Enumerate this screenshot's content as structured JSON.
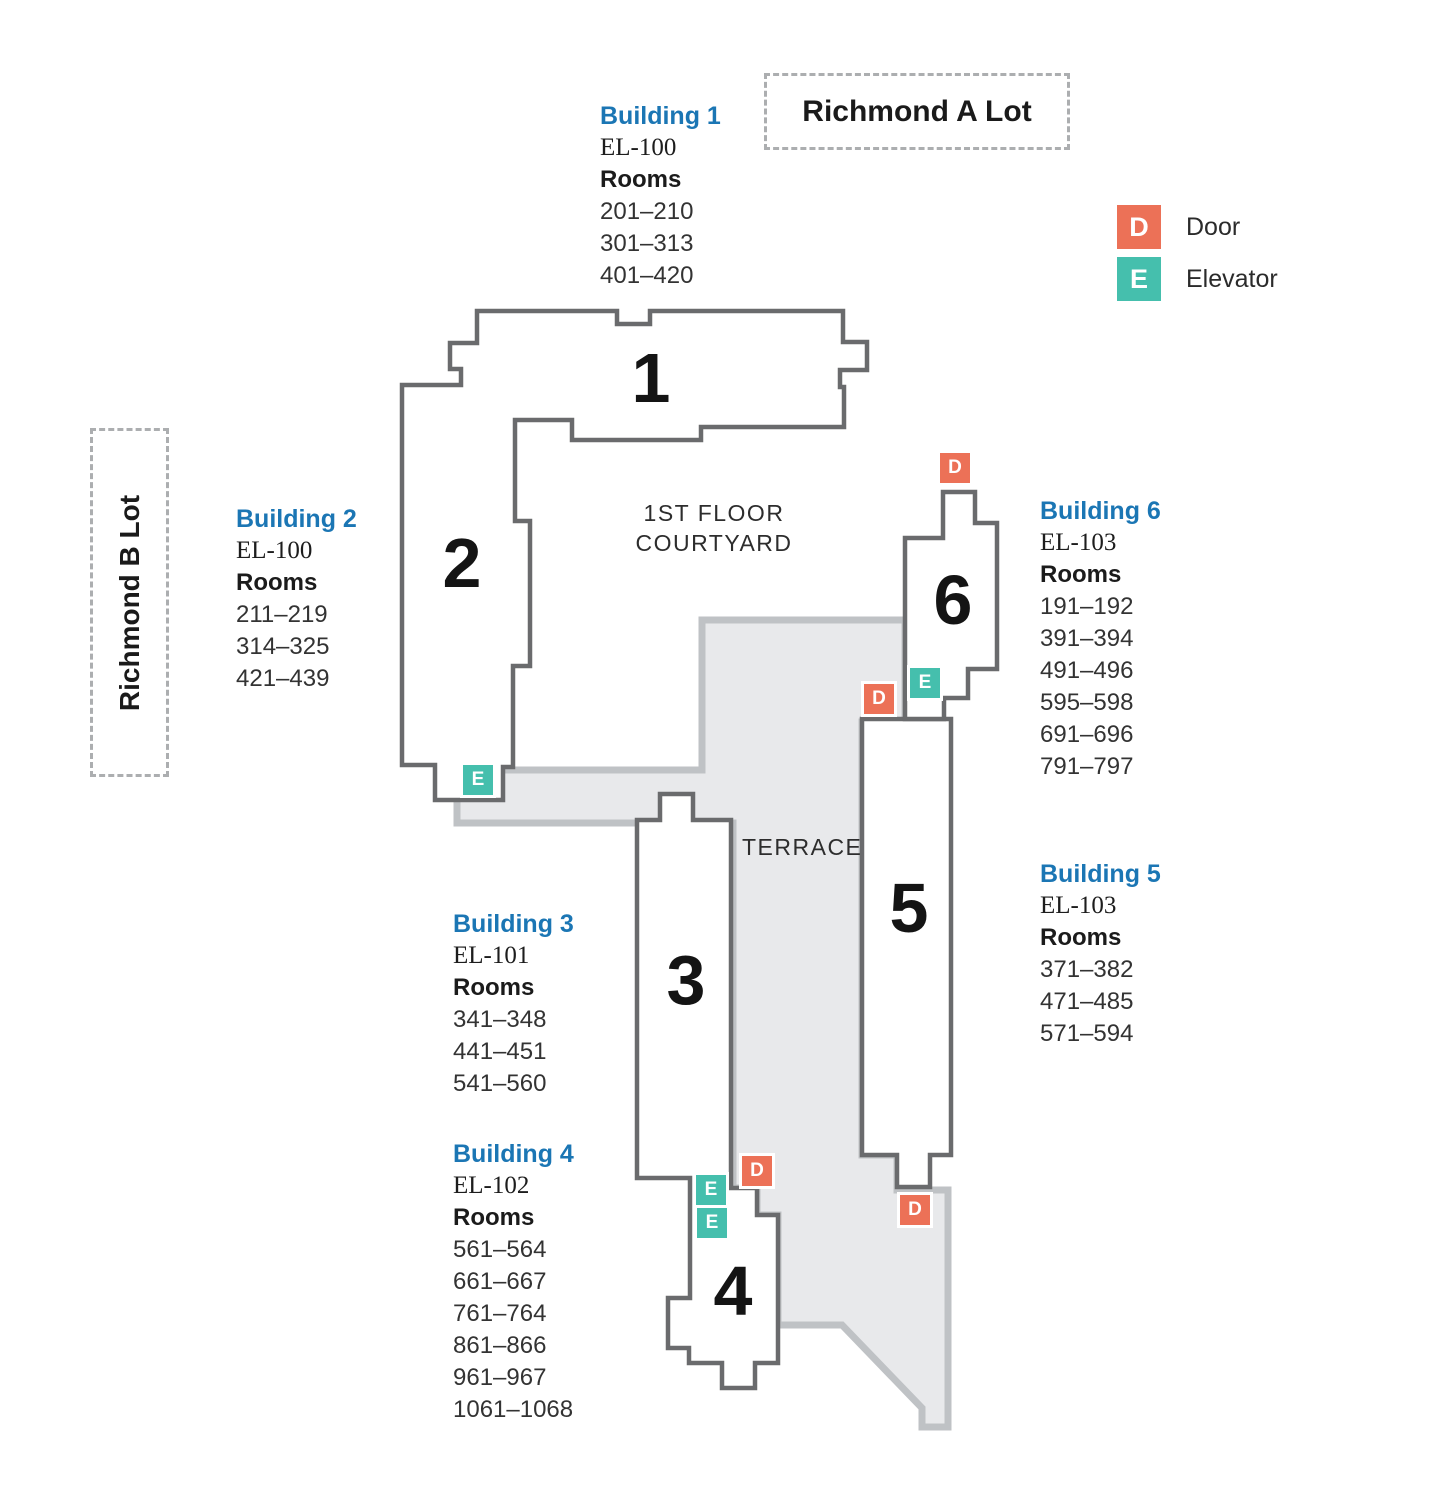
{
  "lots": {
    "a": "Richmond A Lot",
    "b": "Richmond B Lot"
  },
  "legend": {
    "door": {
      "letter": "D",
      "label": "Door"
    },
    "elevator": {
      "letter": "E",
      "label": "Elevator"
    }
  },
  "labels": {
    "courtyard_line1": "1ST FLOOR",
    "courtyard_line2": "COURTYARD",
    "terrace": "TERRACE"
  },
  "colors": {
    "door": "#EC7157",
    "elevator": "#45BFAD",
    "heading": "#1B76B4",
    "building_outline": "#6A6B6D",
    "terrace_fill": "#E8E9EB",
    "terrace_border": "#BFC2C5"
  },
  "buildings": [
    {
      "number": "1",
      "title": "Building 1",
      "el": "EL-100",
      "rooms_label": "Rooms",
      "rooms": [
        "201–210",
        "301–313",
        "401–420"
      ]
    },
    {
      "number": "2",
      "title": "Building 2",
      "el": "EL-100",
      "rooms_label": "Rooms",
      "rooms": [
        "211–219",
        "314–325",
        "421–439"
      ]
    },
    {
      "number": "3",
      "title": "Building 3",
      "el": "EL-101",
      "rooms_label": "Rooms",
      "rooms": [
        "341–348",
        "441–451",
        "541–560"
      ]
    },
    {
      "number": "4",
      "title": "Building 4",
      "el": "EL-102",
      "rooms_label": "Rooms",
      "rooms": [
        "561–564",
        "661–667",
        "761–764",
        "861–866",
        "961–967",
        "1061–1068"
      ]
    },
    {
      "number": "5",
      "title": "Building 5",
      "el": "EL-103",
      "rooms_label": "Rooms",
      "rooms": [
        "371–382",
        "471–485",
        "571–594"
      ]
    },
    {
      "number": "6",
      "title": "Building 6",
      "el": "EL-103",
      "rooms_label": "Rooms",
      "rooms": [
        "191–192",
        "391–394",
        "491–496",
        "595–598",
        "691–696",
        "791–797"
      ]
    }
  ]
}
